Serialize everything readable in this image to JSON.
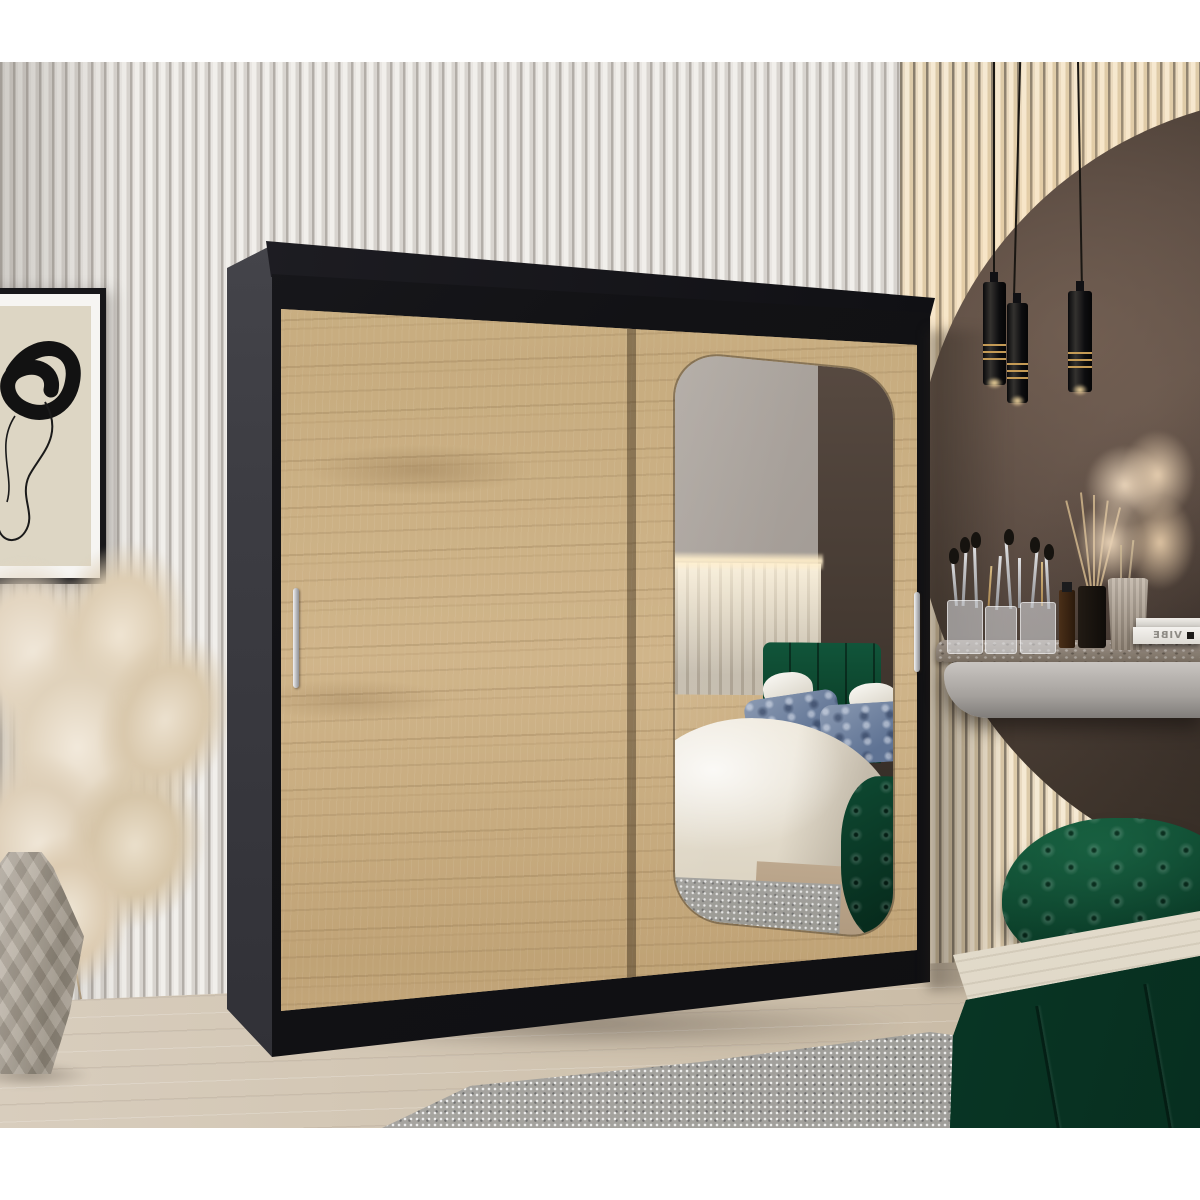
{
  "meta": {
    "type": "interior product photograph",
    "subject": "Two-door sliding wardrobe with mirror in a modern bedroom",
    "canvas": {
      "width": 1200,
      "height": 1200
    }
  },
  "palette": {
    "white_band": "#ffffff",
    "slat_wall_light": "#eceae6",
    "slat_wall_groove": "#b3aea8",
    "slat_wall_warm": "#f0e2c9",
    "arch_wall_dark": "#43382f",
    "backlight_glow": "#ffe2a8",
    "wardrobe_frame_black": "#141417",
    "wardrobe_side_grey": "#3d3d43",
    "oak_door": "#c9ae83",
    "oak_grain": "#a98a5e",
    "handle_silver": "#c9cacd",
    "mirror_grey": "#aba49d",
    "headboard_green": "#0b4029",
    "ottoman_green": "#0a3b27",
    "bed_green": "#0a3f2b",
    "duvet_cream": "#e8e2d5",
    "pillow_blue": "#6f82a1",
    "floor_wood": "#cfc2ae",
    "rug_grey": "#a3a19d",
    "pampas_beige": "#e8dcc8",
    "vase_stone": "#b1a89b",
    "marble_top": "#8b7f72"
  },
  "scene": {
    "left_area": {
      "wall": "white vertical slat panelling",
      "wall_art": "abstract black brush-stroke line art, black frame, white mat",
      "plant": "dried pampas grass in faceted geometric stone vase"
    },
    "wardrobe": {
      "label": "sliding-door wardrobe, black carcass with Sonoma oak doors",
      "left_door": "plain oak sliding door with vertical silver handle",
      "right_door": "oak sliding door with rounded-corner mirror and silver handle",
      "mirror_reflection": [
        "grey wall",
        "LED backlit slat headboard wall",
        "green upholstered panel headboard",
        "white pillows",
        "blue patterned pillows",
        "cream duvet",
        "green bed base",
        "grey rug",
        "green tufted ottoman"
      ]
    },
    "right_area": {
      "wall": "dark textured plaster circular arch niche with warm LED edge glow",
      "pendant_lights": {
        "count": 3,
        "style": "black cylinder pendants with gold rings and warm down-light"
      },
      "vanity": {
        "top": "grey marble floating shelf",
        "front": "light grey rounded console",
        "items": [
          "makeup brushes in clear acrylic holders",
          "perfume bottles",
          "black reed diffuser with rattan sticks",
          "ribbed stone vase with dried beige flowers",
          "stacked white books"
        ],
        "book_spine_text": "VIBE"
      },
      "ottoman": "emerald green chesterfield tufted pouf",
      "bed": "emerald green channel-tufted bed corner with white mattress"
    },
    "floor": "light oak laminate planks",
    "rug": "grey shaggy rug",
    "framing": "white horizontal bands at top and bottom of the photo"
  }
}
